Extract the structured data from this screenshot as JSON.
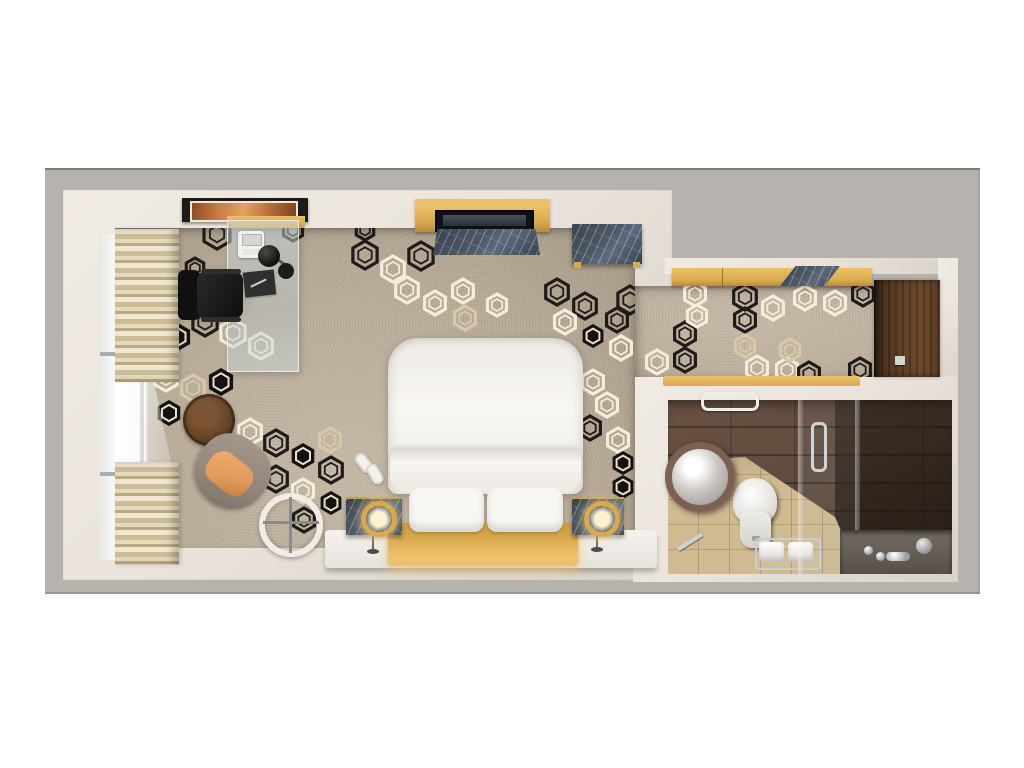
{
  "scene": {
    "kind": "3d-rendered top-down floor plan of a hotel guest room",
    "rooms": [
      {
        "name": "bedroom",
        "items": [
          "window",
          "striped-curtain",
          "wall-art",
          "glass-desk",
          "telephone",
          "desk-lamp",
          "desk-mat",
          "office-chair",
          "tv-console",
          "tv-screen",
          "marble-dresser",
          "marble-bench",
          "coffee-table",
          "armchair",
          "floor-mirror",
          "double-bed",
          "duvet-fold",
          "pillow",
          "pillow",
          "slippers",
          "nightstand",
          "nightstand",
          "table-lamp",
          "table-lamp",
          "bed-platform",
          "gold-headboard"
        ]
      },
      {
        "name": "entry-hall",
        "items": [
          "closet-gold-front",
          "closet-marble-counter",
          "entry-door",
          "gold-threshold",
          "carpet"
        ]
      },
      {
        "name": "bathroom",
        "items": [
          "round-vessel-sink",
          "toilet",
          "towel-rack",
          "rolled-towel",
          "rolled-towel",
          "towel-bar",
          "shower-glass-panel",
          "shower-glass-panel",
          "shower-door-handle",
          "bathtub",
          "chrome-faucet",
          "floor-squeegee"
        ]
      }
    ]
  },
  "palette": {
    "page_bg": "#ffffff",
    "outer_wall_gray": "#b6b2ae",
    "outer_wall_edge": "#7e7a76",
    "inner_wall_cream": "#eae4dc",
    "inner_wall_shade": "#d9d2c9",
    "carpet_beige": "#b9ac99",
    "carpet_hall": "#bfb2a0",
    "accent_gold": "#d9a94e",
    "accent_gold_light": "#ecc169",
    "door_wood": "#5a3b25",
    "marble_blue_gray": "#4d5866",
    "bath_wall_brown": "#5f4b3e",
    "bath_floor_tan": "#cfba92",
    "furniture_white": "#f5f3f0",
    "chair_black": "#161616",
    "cushion_orange": "#e09a5c",
    "armchair_taupe": "#94867a",
    "hex_dark": "#1f1b18",
    "hex_light": "#f4edda",
    "hex_cream": "#d7c9a8"
  },
  "carpet_pattern": {
    "shape": "nested-hexagons",
    "bedroom_hexagons": [
      [
        172,
        64,
        15,
        "d"
      ],
      [
        150,
        98,
        10,
        "d"
      ],
      [
        129,
        128,
        11,
        "d"
      ],
      [
        133,
        167,
        14,
        "s"
      ],
      [
        160,
        152,
        14,
        "d"
      ],
      [
        188,
        163,
        14,
        "l"
      ],
      [
        216,
        176,
        13,
        "l"
      ],
      [
        121,
        208,
        13,
        "l"
      ],
      [
        148,
        218,
        13,
        "c"
      ],
      [
        176,
        212,
        14,
        "s"
      ],
      [
        124,
        243,
        13,
        "s"
      ],
      [
        152,
        245,
        12,
        "c"
      ],
      [
        205,
        262,
        13,
        "l"
      ],
      [
        231,
        273,
        13,
        "d"
      ],
      [
        258,
        286,
        13,
        "s"
      ],
      [
        205,
        297,
        13,
        "l"
      ],
      [
        231,
        309,
        13,
        "d"
      ],
      [
        258,
        321,
        12,
        "l"
      ],
      [
        286,
        300,
        13,
        "d"
      ],
      [
        286,
        333,
        12,
        "s"
      ],
      [
        259,
        350,
        12,
        "d"
      ],
      [
        285,
        270,
        12,
        "c"
      ],
      [
        320,
        85,
        14,
        "d"
      ],
      [
        348,
        99,
        13,
        "l"
      ],
      [
        376,
        86,
        14,
        "d"
      ],
      [
        362,
        120,
        13,
        "l"
      ],
      [
        390,
        133,
        12,
        "l"
      ],
      [
        418,
        121,
        12,
        "l"
      ],
      [
        420,
        148,
        12,
        "c"
      ],
      [
        452,
        135,
        11,
        "l"
      ],
      [
        512,
        122,
        13,
        "d"
      ],
      [
        540,
        136,
        13,
        "d"
      ],
      [
        520,
        152,
        12,
        "l"
      ],
      [
        548,
        166,
        12,
        "s"
      ],
      [
        572,
        150,
        12,
        "d"
      ],
      [
        585,
        130,
        14,
        "d"
      ],
      [
        576,
        178,
        12,
        "l"
      ],
      [
        548,
        212,
        12,
        "l"
      ],
      [
        562,
        235,
        12,
        "l"
      ],
      [
        545,
        258,
        12,
        "d"
      ],
      [
        573,
        270,
        12,
        "l"
      ],
      [
        578,
        293,
        12,
        "s"
      ],
      [
        578,
        317,
        12,
        "s"
      ],
      [
        320,
        60,
        10,
        "d"
      ],
      [
        248,
        60,
        11,
        "d"
      ]
    ],
    "hall_hexagons": [
      [
        650,
        124,
        12,
        "l"
      ],
      [
        700,
        127,
        13,
        "d"
      ],
      [
        700,
        150,
        12,
        "d"
      ],
      [
        728,
        138,
        12,
        "l"
      ],
      [
        760,
        128,
        12,
        "l"
      ],
      [
        790,
        133,
        12,
        "l"
      ],
      [
        818,
        124,
        12,
        "d"
      ],
      [
        640,
        164,
        12,
        "d"
      ],
      [
        640,
        190,
        12,
        "d"
      ],
      [
        612,
        192,
        12,
        "l"
      ],
      [
        712,
        198,
        12,
        "l"
      ],
      [
        742,
        200,
        12,
        "l"
      ],
      [
        764,
        204,
        12,
        "d"
      ],
      [
        745,
        180,
        11,
        "c"
      ],
      [
        700,
        176,
        11,
        "c"
      ],
      [
        815,
        200,
        12,
        "d"
      ],
      [
        652,
        146,
        11,
        "l"
      ]
    ]
  },
  "curtain": {
    "stripe_colors": [
      "#efe7d2",
      "#cbbc96",
      "#e4d9bd",
      "#b9a982"
    ]
  }
}
